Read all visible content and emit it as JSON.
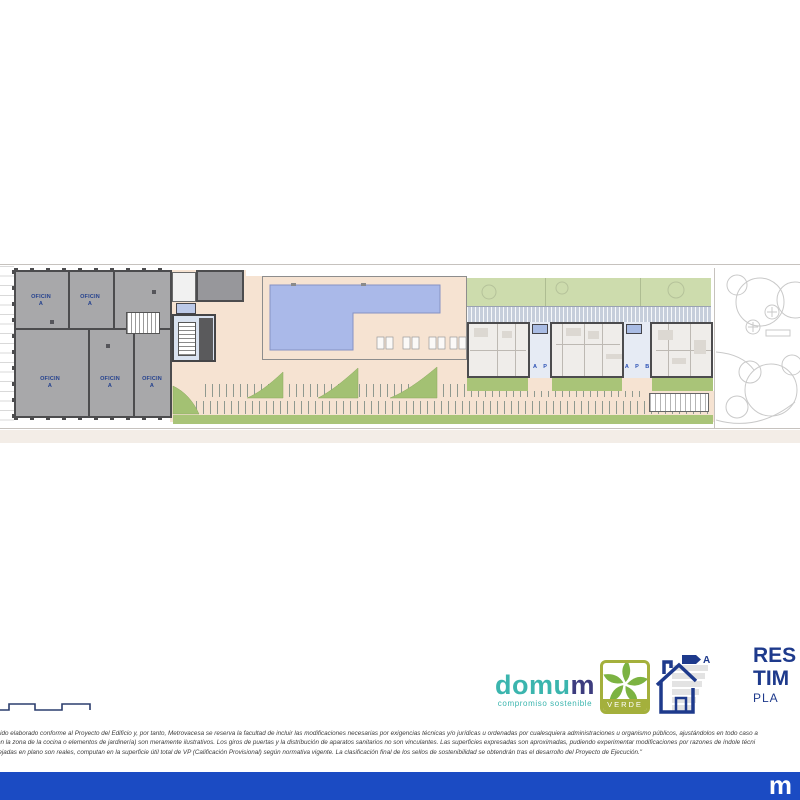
{
  "plan": {
    "office_room_label": {
      "line1": "OFICIN",
      "line2": "A"
    },
    "portal_a_label": "A P",
    "portal_b_label": "A P B"
  },
  "branding": {
    "domum_prefix": "domu",
    "domum_suffix": "m",
    "domum_tagline": "compromiso sostenible",
    "verde_label": "VERDE",
    "energy_rating": "A",
    "title_line1": "RES",
    "title_line2": "TIM",
    "title_line3": "PLA"
  },
  "disclaimer": {
    "line1": "sido elaborado conforme al Proyecto del Edificio y, por tanto, Metrovacesa se reserva la facultad de incluir las modificaciones necesarias por exigencias técnicas y/o jurídicas u ordenadas por cualesquiera administraciones u organismo públicos, ajustándolos en todo caso a",
    "line2": "en la zona de la cocina o elementos de jardinería) son meramente ilustrativos. Los giros de puertas y la distribución de aparatos sanitarios no son vinculantes. Las superficies expresadas son aproximadas, pudiendo experimentar modificaciones por razones de índole técni",
    "line3": "lejadas en plano son reales, computan en la superficie útil total de VP (Calificación Provisional) según normativa vigente. La clasificación final de los sellos de sostenibilidad se obtendrán tras el desarrollo del Proyecto de Ejecución.\""
  },
  "footer": {
    "brand_initial": "m"
  },
  "colors": {
    "pool_blue": "#aab9e9",
    "ground_peach": "#f6e3d2",
    "green_olive": "#a9c478",
    "green_sage": "#cddcad",
    "office_gray": "#a8a8aa",
    "navy_text": "#1e3a8c",
    "domum_teal": "#3bb5ae",
    "domum_indigo": "#3d3c7e",
    "verde_olive": "#a4b03c",
    "footer_blue": "#1b4bc3"
  }
}
